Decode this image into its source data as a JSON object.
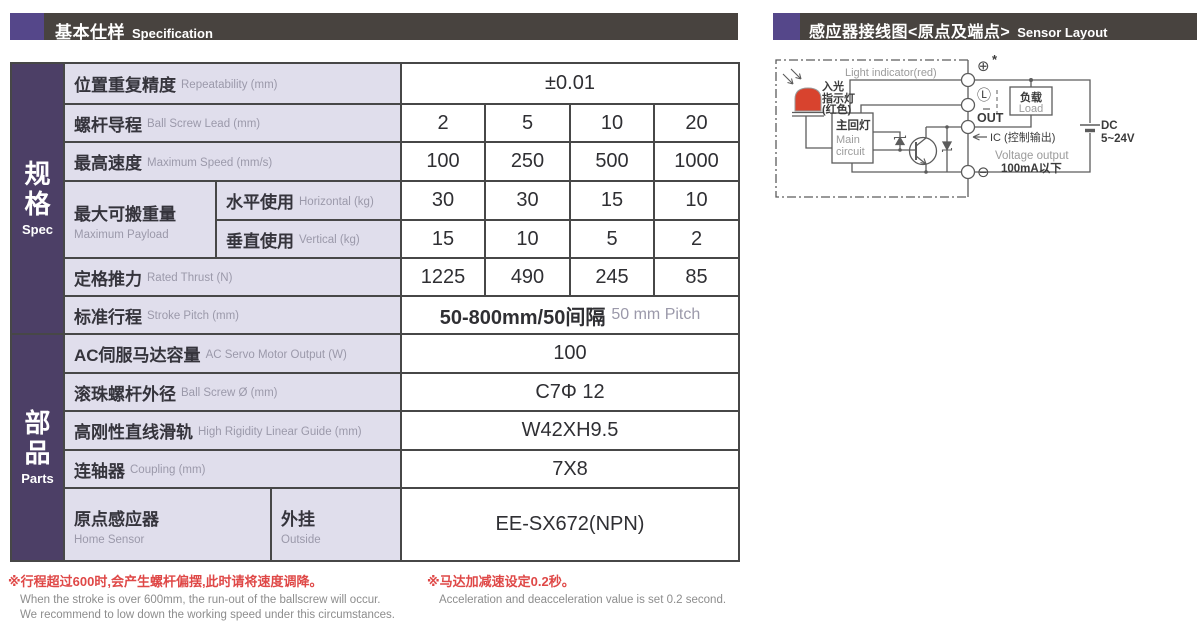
{
  "left_header": {
    "title_zh": "基本仕样",
    "title_en": "Specification"
  },
  "right_header": {
    "title_zh": "感应器接线图<原点及端点>",
    "title_en": "Sensor Layout"
  },
  "sidebar": {
    "spec_zh": "规格",
    "spec_en": "Spec",
    "parts_zh": "部品",
    "parts_en": "Parts"
  },
  "table": {
    "rows": {
      "repeatability": {
        "zh": "位置重复精度",
        "en": "Repeatability (mm)",
        "value": "±0.01"
      },
      "lead": {
        "zh": "螺杆导程",
        "en": "Ball Screw Lead (mm)",
        "values": [
          "2",
          "5",
          "10",
          "20"
        ]
      },
      "speed": {
        "zh": "最高速度",
        "en": "Maximum Speed (mm/s)",
        "values": [
          "100",
          "250",
          "500",
          "1000"
        ]
      },
      "payload": {
        "zh": "最大可搬重量",
        "en": "Maximum Payload",
        "horizontal": {
          "zh": "水平使用",
          "en": "Horizontal (kg)",
          "values": [
            "30",
            "30",
            "15",
            "10"
          ]
        },
        "vertical": {
          "zh": "垂直使用",
          "en": "Vertical (kg)",
          "values": [
            "15",
            "10",
            "5",
            "2"
          ]
        }
      },
      "thrust": {
        "zh": "定格推力",
        "en": "Rated Thrust (N)",
        "values": [
          "1225",
          "490",
          "245",
          "85"
        ]
      },
      "stroke": {
        "zh": "标准行程",
        "en": "Stroke Pitch (mm)",
        "value_main": "50-800mm/50间隔",
        "value_sub": "50 mm Pitch"
      },
      "motor": {
        "zh": "AC伺服马达容量",
        "en": "AC Servo Motor Output (W)",
        "value": "100"
      },
      "screw_dia": {
        "zh": "滚珠螺杆外径",
        "en": "Ball Screw Ø (mm)",
        "value": "C7Φ 12"
      },
      "guide": {
        "zh": "高刚性直线滑轨",
        "en": "High Rigidity Linear Guide (mm)",
        "value": "W42XH9.5"
      },
      "coupling": {
        "zh": "连轴器",
        "en": "Coupling (mm)",
        "value": "7X8"
      },
      "home_sensor": {
        "zh": "原点感应器",
        "en": "Home Sensor",
        "type_zh": "外挂",
        "type_en": "Outside",
        "value": "EE-SX672(NPN)"
      }
    }
  },
  "notes": {
    "n1_zh": "※行程超过600时,会产生螺杆偏摆,此时请将速度调降。",
    "n1_en1": "When the stroke is over 600mm, the run-out of the ballscrew will occur.",
    "n1_en2": "We recommend to low down the working speed under this circumstances.",
    "n2_zh": "※马达加减速设定0.2秒。",
    "n2_en": "Acceleration and deacceleration value is set 0.2 second."
  },
  "diagram": {
    "light_indicator_en": "Light indicator(red)",
    "light_indicator_zh1": "入光",
    "light_indicator_zh2": "指示灯",
    "light_indicator_zh3": "(红色)",
    "main_circuit_zh": "主回灯",
    "main_circuit_en1": "Main",
    "main_circuit_en2": "circuit",
    "plus_terminal": "⊕",
    "star": "*",
    "l_terminal": "Ⓛ",
    "out_label": "OUT",
    "ic_label": "IC (控制输出)",
    "voltage_output": "Voltage output",
    "current_limit": "100mA以下",
    "minus_terminal": "⊖",
    "load_zh": "负载",
    "load_en": "Load",
    "dc_line1": "DC",
    "dc_line2": "5~24V"
  },
  "colors": {
    "header_bar": "#48433f",
    "accent_purple": "#55478a",
    "sidebar_purple": "#4c3f66",
    "label_cell_bg": "#e0deec",
    "table_border": "#474747",
    "note_red": "#df4847",
    "led_red": "#d8432e"
  }
}
